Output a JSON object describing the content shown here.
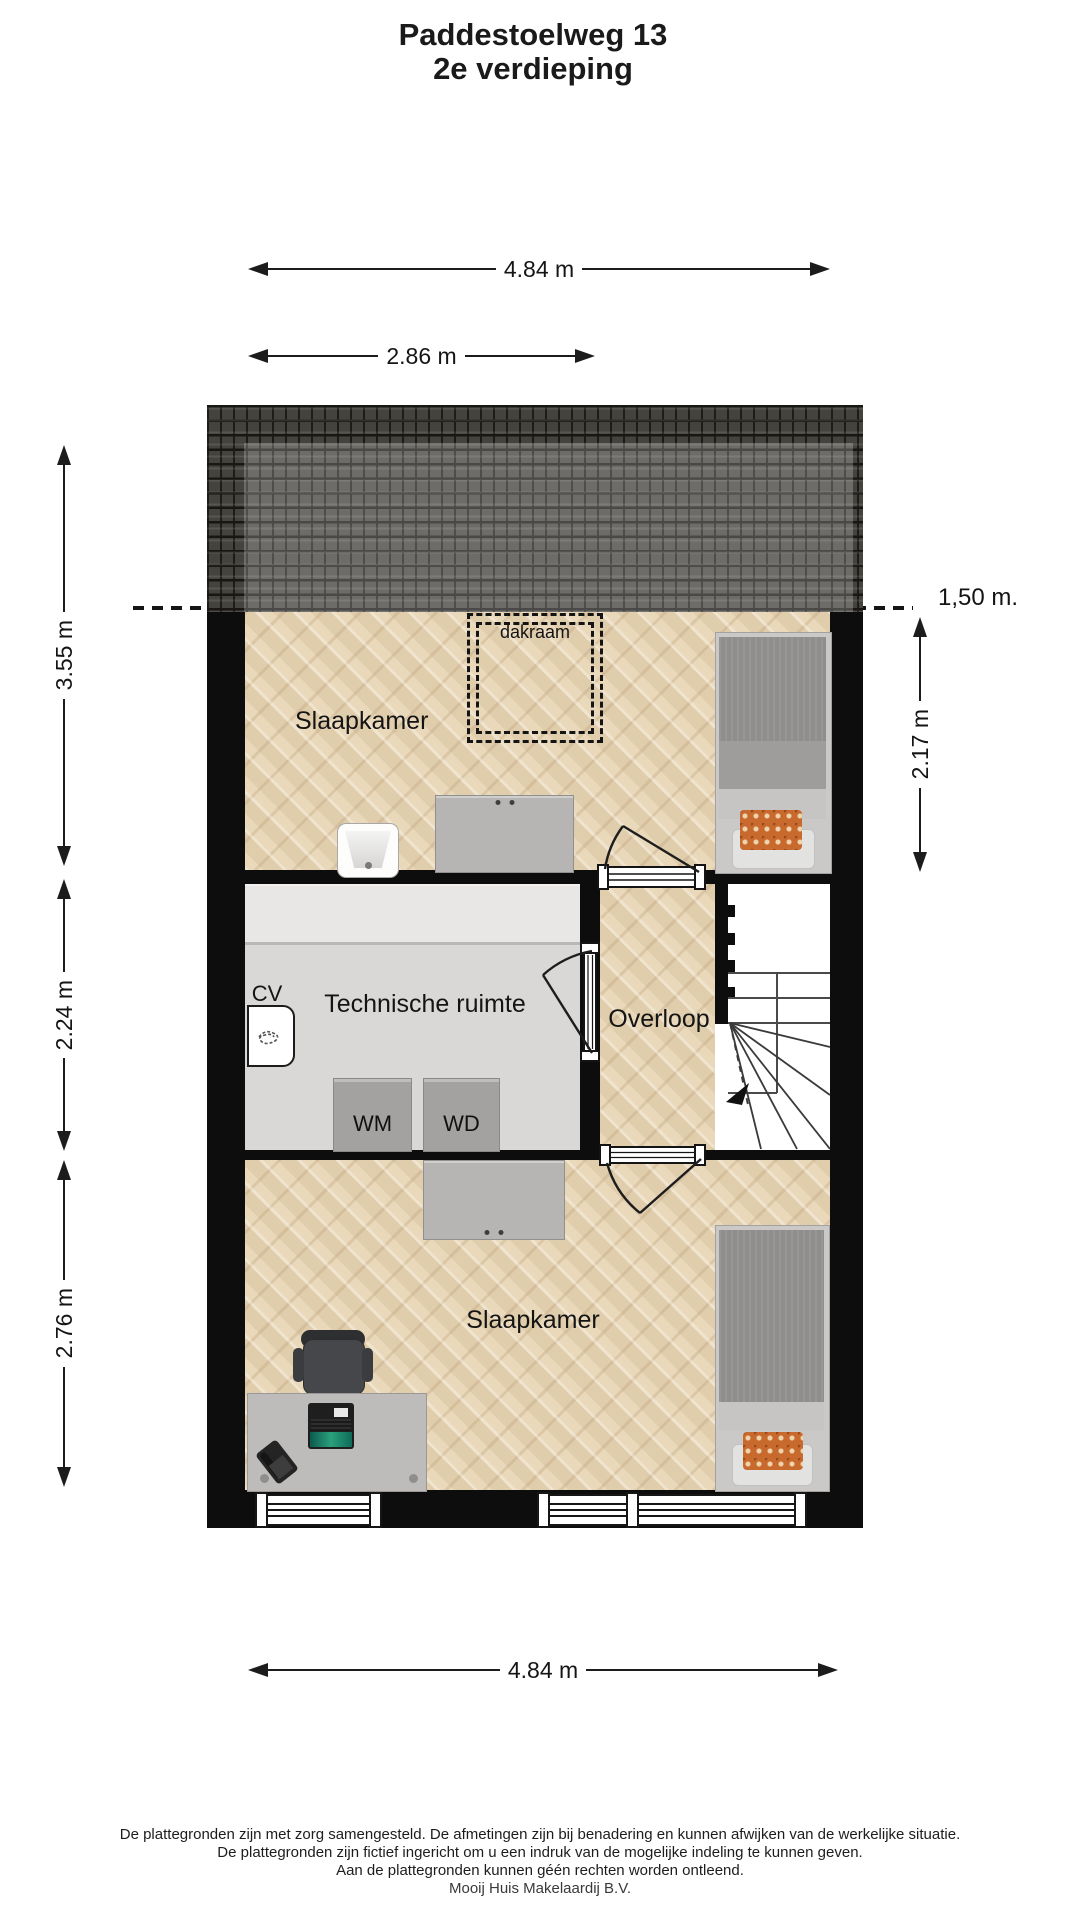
{
  "title": {
    "line1": "Paddestoelweg 13",
    "line2": "2e verdieping"
  },
  "dimensions": {
    "top_width": "4.84 m",
    "top_inner_width": "2.86 m",
    "left_upper": "3.55 m",
    "left_middle": "2.24 m",
    "left_lower": "2.76 m",
    "right_bedroom_depth": "2.17 m",
    "headroom_line": "1,50 m.",
    "bottom_width": "4.84 m"
  },
  "rooms": {
    "bedroom_top": "Slaapkamer",
    "technical_room": "Technische ruimte",
    "landing": "Overloop",
    "bedroom_bottom": "Slaapkamer"
  },
  "fixtures": {
    "skylight": "dakraam",
    "central_heating": "CV",
    "washing_machine": "WM",
    "dryer": "WD"
  },
  "footer": {
    "line1": "De plattegronden zijn met zorg samengesteld. De afmetingen zijn bij benadering en kunnen afwijken van de werkelijke situatie.",
    "line2": "De plattegronden zijn fictief ingericht om u een indruk van de mogelijke indeling te kunnen geven.",
    "line3": "Aan de plattegronden kunnen géén rechten worden ontleend.",
    "line4": "Mooij Huis Makelaardij B.V."
  },
  "colors": {
    "wall": "#0d0d0d",
    "dim": "#1c1c1c",
    "parquet": "#e9d8ba",
    "roof_base": "#45433e",
    "tech_floor": "#d9d8d6",
    "counter": "#e8e7e5",
    "furniture_gray": "#b6b5b3",
    "bed_duvet": "#8f8e8c",
    "accent_orange": "#c8692d"
  }
}
